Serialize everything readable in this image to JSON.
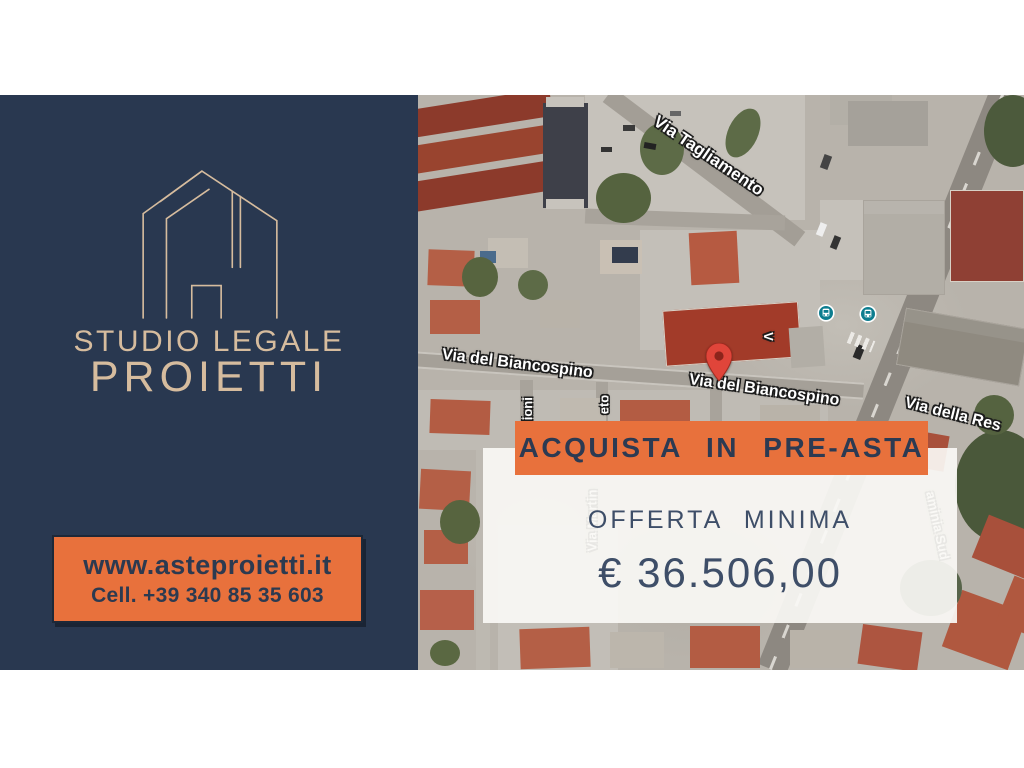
{
  "brand": {
    "studio_line1": "STUDIO LEGALE",
    "studio_line2": "PROIETTI",
    "website": "www.asteproietti.it",
    "phone": "Cell. +39 340 85 35 603",
    "logo_icon": "house-outline-icon",
    "colors": {
      "navy": "#293850",
      "beige": "#d6bc9e",
      "orange": "#e8713c"
    }
  },
  "offer": {
    "banner": "ACQUISTA  IN  PRE-ASTA",
    "label": "OFFERTA  MINIMA",
    "amount": "€ 36.506,00"
  },
  "map": {
    "street_labels": [
      {
        "text": "Via Tagliamento"
      },
      {
        "text": "Via del Biancospino"
      },
      {
        "text": "Via del Biancospino"
      },
      {
        "text": "Via della Res"
      },
      {
        "text": "lioni"
      },
      {
        "text": "eto"
      },
      {
        "text": "V"
      },
      {
        "text": "aminia Sud"
      },
      {
        "text": "Via Martin"
      }
    ],
    "icons": {
      "pin": "map-pin-icon",
      "pin_color": "#e0453a",
      "bus": "bus-stop-icon",
      "bus_color": "#0d7d8f"
    }
  }
}
